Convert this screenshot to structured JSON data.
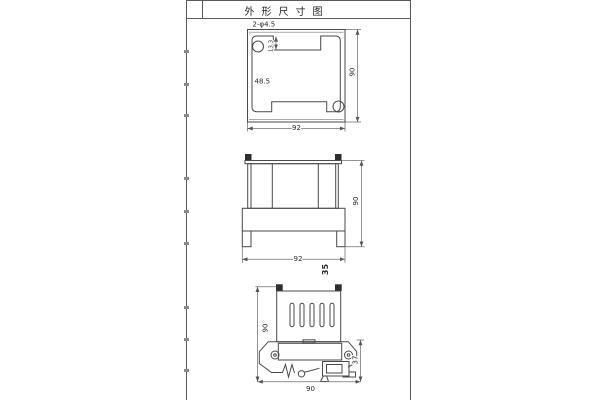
{
  "sheet": {
    "title": "外形尺寸图"
  },
  "views": {
    "top": {
      "hole_label": "2-φ4.5",
      "dims": {
        "step": "13.3",
        "inner": "48.5",
        "height": "90",
        "width": "92"
      }
    },
    "front": {
      "dims": {
        "width": "92",
        "depth": "35",
        "height": "90"
      }
    },
    "side": {
      "dims": {
        "height": "90",
        "rail": "37",
        "width": "90"
      }
    }
  }
}
